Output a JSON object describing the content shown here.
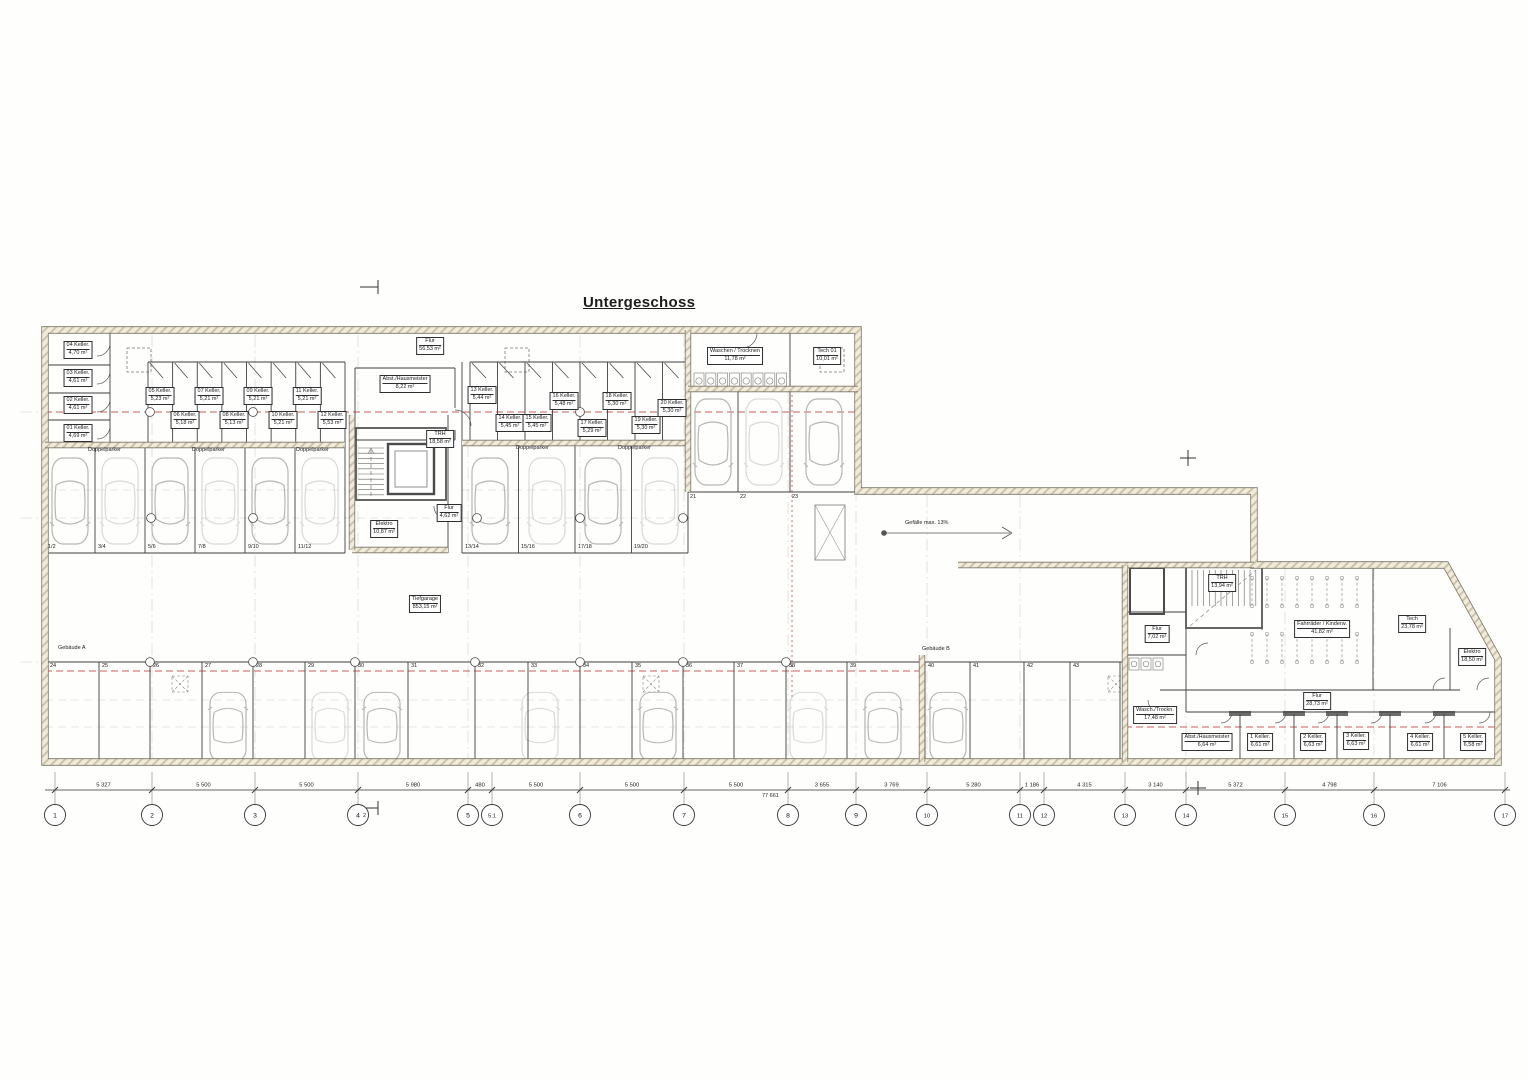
{
  "title": "Untergeschoss",
  "buildings": {
    "a": "Gebäude A",
    "b": "Gebäude B"
  },
  "ramp_label": "Gefälle max. 13%",
  "garage": {
    "name": "Tiefgarage",
    "area": "853,15 m²"
  },
  "rooms_main": [
    {
      "name": "Flur",
      "area": "56,53 m²"
    },
    {
      "name": "Abst./Hausmeister",
      "area": "8,22 m²"
    },
    {
      "name": "TRH",
      "area": "18,58 m²"
    },
    {
      "name": "Elektro",
      "area": "10,87 m²"
    },
    {
      "name": "Flur",
      "area": "4,62 m²"
    },
    {
      "name": "Waschen / Trocknen",
      "area": "11,78 m²"
    },
    {
      "name": "Tech 01",
      "area": "10,01 m²"
    }
  ],
  "cellars_left": [
    {
      "name": "04 Keller.",
      "area": "4,70 m²"
    },
    {
      "name": "03 Keller.",
      "area": "4,61 m²"
    },
    {
      "name": "02 Keller.",
      "area": "4,61 m²"
    },
    {
      "name": "01 Keller.",
      "area": "4,69 m²"
    }
  ],
  "cellars_row_a": [
    {
      "name": "05 Keller.",
      "area": "5,23 m²"
    },
    {
      "name": "06 Keller.",
      "area": "5,18 m²"
    },
    {
      "name": "07 Keller.",
      "area": "5,21 m²"
    },
    {
      "name": "08 Keller.",
      "area": "5,13 m²"
    },
    {
      "name": "09 Keller.",
      "area": "5,21 m²"
    },
    {
      "name": "10 Keller.",
      "area": "5,21 m²"
    },
    {
      "name": "11 Keller.",
      "area": "5,21 m²"
    },
    {
      "name": "12 Keller.",
      "area": "5,53 m²"
    }
  ],
  "cellars_row_b": [
    {
      "name": "13 Keller.",
      "area": "5,44 m²"
    },
    {
      "name": "14 Keller.",
      "area": "5,45 m²"
    },
    {
      "name": "15 Keller.",
      "area": "5,45 m²"
    },
    {
      "name": "16 Keller.",
      "area": "5,48 m²"
    },
    {
      "name": "17 Keller.",
      "area": "5,29 m²"
    },
    {
      "name": "18 Keller.",
      "area": "5,30 m²"
    },
    {
      "name": "19 Keller.",
      "area": "5,30 m²"
    },
    {
      "name": "20 Keller.",
      "area": "5,30 m²"
    }
  ],
  "rooms_b": [
    {
      "name": "TRH",
      "area": "13,94 m²"
    },
    {
      "name": "Flur",
      "area": "7,02 m²"
    },
    {
      "name": "Fahrräder / Kinderw.",
      "area": "41,82 m²"
    },
    {
      "name": "Tech",
      "area": "23,78 m²"
    },
    {
      "name": "Elektro",
      "area": "18,50 m²"
    },
    {
      "name": "Flur",
      "area": "28,73 m²"
    },
    {
      "name": "Wasch./Trockn.",
      "area": "17,48 m²"
    }
  ],
  "cellars_b": [
    {
      "name": "Abst./Hausmeister",
      "area": "6,64 m²"
    },
    {
      "name": "1 Keller.",
      "area": "6,61 m²"
    },
    {
      "name": "2 Keller.",
      "area": "6,63 m²"
    },
    {
      "name": "3 Keller.",
      "area": "6,63 m²"
    },
    {
      "name": "4 Keller.",
      "area": "6,61 m²"
    },
    {
      "name": "5 Keller.",
      "area": "6,58 m²"
    }
  ],
  "parking": {
    "doppelparker_label": "Doppelparker",
    "pairs": [
      "1/2",
      "3/4",
      "5/6",
      "7/8",
      "9/10",
      "11/12",
      "13/14",
      "15/16",
      "17/18",
      "19/20"
    ],
    "top_singles": [
      "21",
      "22",
      "23"
    ],
    "bottom": [
      "24",
      "25",
      "26",
      "27",
      "28",
      "29",
      "30",
      "31",
      "32",
      "33",
      "34",
      "35",
      "36",
      "37",
      "38",
      "39",
      "40",
      "41",
      "42",
      "43"
    ]
  },
  "grid": {
    "bubbles": [
      "1",
      "2",
      "3",
      "4",
      "5",
      "5.1",
      "6",
      "7",
      "8",
      "9",
      "10",
      "11",
      "12",
      "13",
      "14",
      "15",
      "16",
      "17"
    ]
  },
  "dimensions": {
    "segments": [
      "5 327",
      "5 500",
      "5 500",
      "5 980",
      "480",
      "5 500",
      "5 500",
      "5 500",
      "3 655",
      "3 769",
      "5 280",
      "1 186",
      "4 315",
      "3 140",
      "5 372",
      "4 798",
      "7 106"
    ],
    "total": "77 661"
  },
  "section_marker": "2"
}
